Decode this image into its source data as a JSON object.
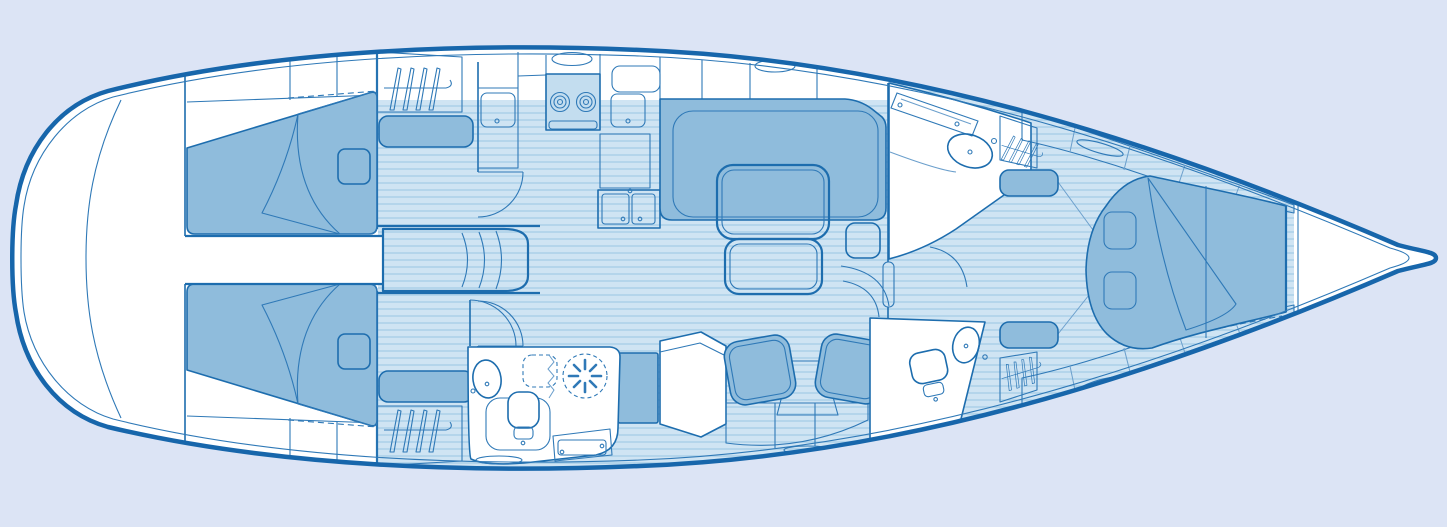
{
  "meta": {
    "title": "Sailing yacht interior layout — top-down deck plan",
    "type": "yacht-floor-plan",
    "orientation": {
      "bow": "right",
      "stern": "left"
    }
  },
  "colors": {
    "bg": "#dce4f5",
    "hull-stroke": "#1766ab",
    "stroke": "#1d6dae",
    "line": "#2f79b7",
    "hairline": "#6b9fcc",
    "white": "#ffffff",
    "floor-base": "#cfe4f3",
    "floor-stripe": "#a9cfe8",
    "cushion": "#8fbcdc",
    "cushion-light": "#c6ddef",
    "panel-light": "#c3ddef",
    "pillow-light": "#d7e9f6"
  },
  "rooms": [
    {
      "name": "aft-cabin-starboard",
      "features": [
        "double-berth",
        "turned-down-sheet",
        "pillow",
        "hanging-locker",
        "seat",
        "door"
      ]
    },
    {
      "name": "aft-cabin-port",
      "features": [
        "double-berth",
        "turned-down-sheet",
        "pillow",
        "hanging-locker",
        "seat",
        "door"
      ]
    },
    {
      "name": "engine-room-companionway",
      "features": [
        "companionway-steps",
        "engine-box"
      ]
    },
    {
      "name": "galley",
      "features": [
        "two-burner-stove",
        "oven-tray",
        "top-load-fridge",
        "single-sink",
        "double-sink",
        "counters",
        "overhead-hatch"
      ]
    },
    {
      "name": "saloon",
      "features": [
        "u-shaped-settee",
        "folding-table-two-leaves",
        "side-seat",
        "overhead-hatch",
        "companionway-door"
      ]
    },
    {
      "name": "nav-station",
      "features": [
        "chart-desk",
        "bookshelf",
        "two-armchairs"
      ]
    },
    {
      "name": "head-midship",
      "features": [
        "washbasin",
        "toilet",
        "shower",
        "folding-screen",
        "bench",
        "drawer-step",
        "rug",
        "door"
      ]
    },
    {
      "name": "vanity-starboard",
      "features": [
        "bench",
        "washbasin",
        "door"
      ]
    },
    {
      "name": "head-forward",
      "features": [
        "toilet",
        "washbasin",
        "door"
      ]
    },
    {
      "name": "forward-cabin",
      "features": [
        "double-berth",
        "turned-down-sheet",
        "two-pillows",
        "two-hanging-lockers",
        "two-benches",
        "shelf-bands",
        "handrails"
      ]
    },
    {
      "name": "bow-anchor-locker",
      "features": [
        "chain-locker-bulkheads"
      ]
    }
  ],
  "icons": [
    "hanger-icon",
    "shower-drain-icon",
    "toilet-icon",
    "washbasin-icon",
    "stove-burner-icon",
    "sink-drain-icon",
    "hatch-oval-icon",
    "door-swing-icon"
  ]
}
